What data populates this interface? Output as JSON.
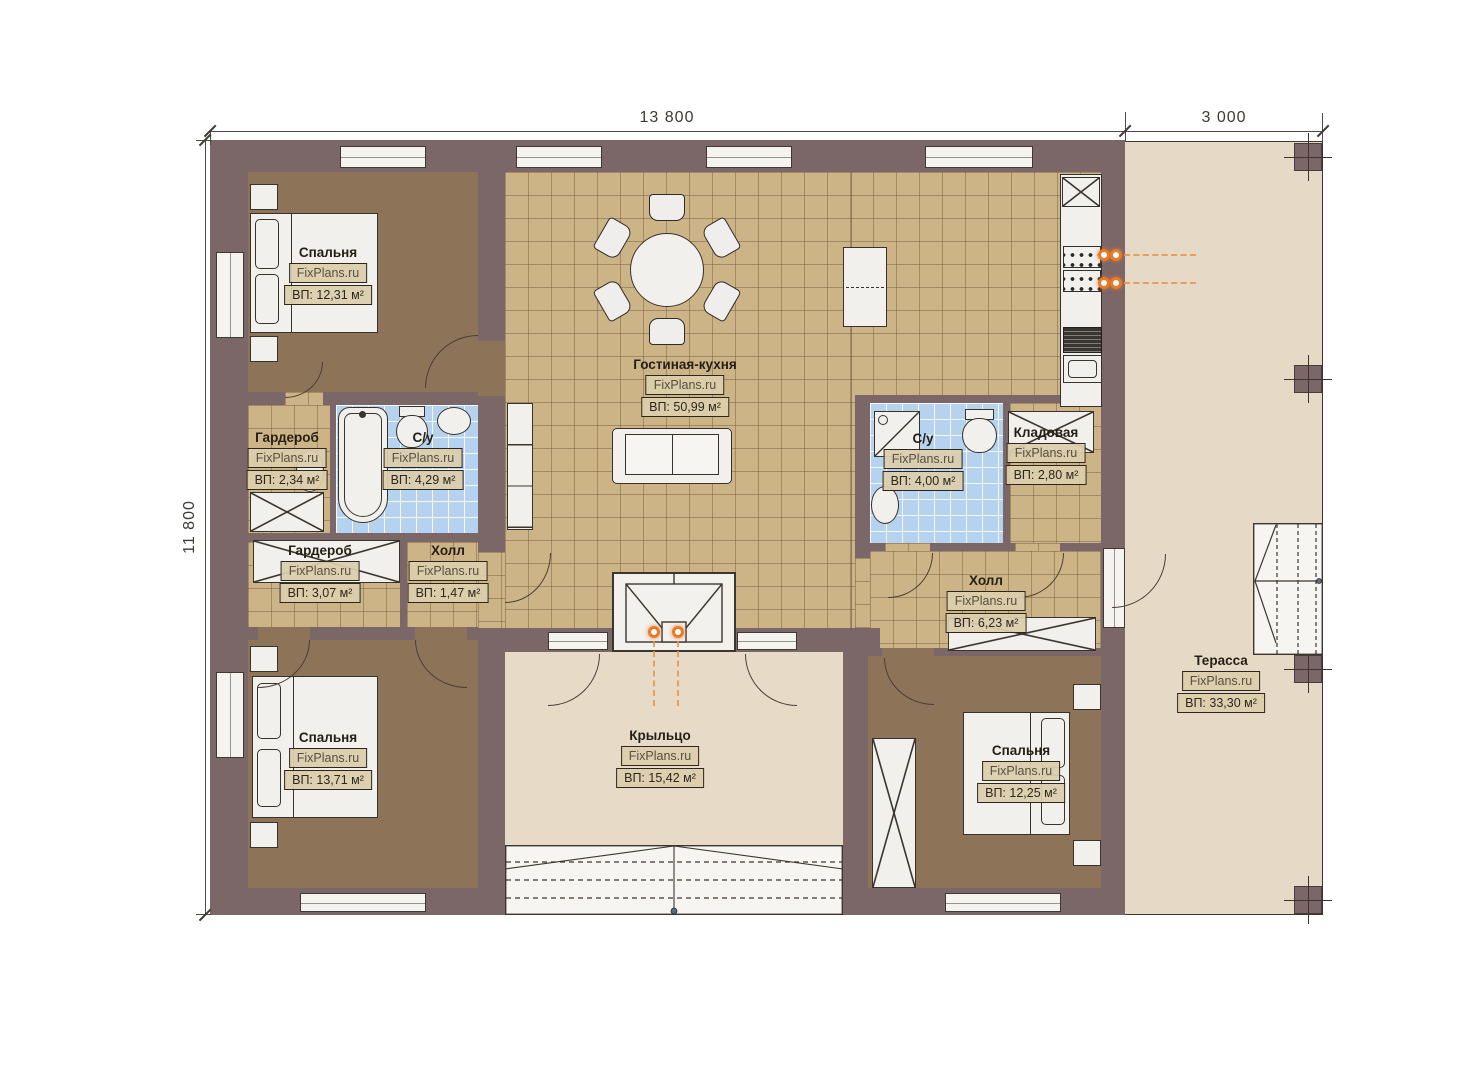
{
  "watermark": "FixPlans.ru",
  "dimensions": {
    "top_main": "13 800",
    "top_terrace": "3 000",
    "left_side": "11 800"
  },
  "rooms": {
    "bedroom_tl": {
      "name": "Спальня",
      "area": "ВП: 12,31 м²"
    },
    "wardrobe_tl": {
      "name": "Гардероб",
      "area": "ВП: 2,34 м²"
    },
    "bath_left": {
      "name": "С/у",
      "area": "ВП: 4,29 м²"
    },
    "living_kitchen": {
      "name": "Гостиная-кухня",
      "area": "ВП: 50,99 м²"
    },
    "wardrobe_left": {
      "name": "Гардероб",
      "area": "ВП: 3,07 м²"
    },
    "hall_small": {
      "name": "Холл",
      "area": "ВП: 1,47 м²"
    },
    "bath_right": {
      "name": "С/у",
      "area": "ВП: 4,00 м²"
    },
    "storage": {
      "name": "Кладовая",
      "area": "ВП: 2,80 м²"
    },
    "hall_right": {
      "name": "Холл",
      "area": "ВП: 6,23 м²"
    },
    "bedroom_bl": {
      "name": "Спальня",
      "area": "ВП: 13,71 м²"
    },
    "porch": {
      "name": "Крыльцо",
      "area": "ВП: 15,42 м²"
    },
    "bedroom_br": {
      "name": "Спальня",
      "area": "ВП: 12,25 м²"
    },
    "terrace": {
      "name": "Терасса",
      "area": "ВП: 33,30 м²"
    }
  }
}
